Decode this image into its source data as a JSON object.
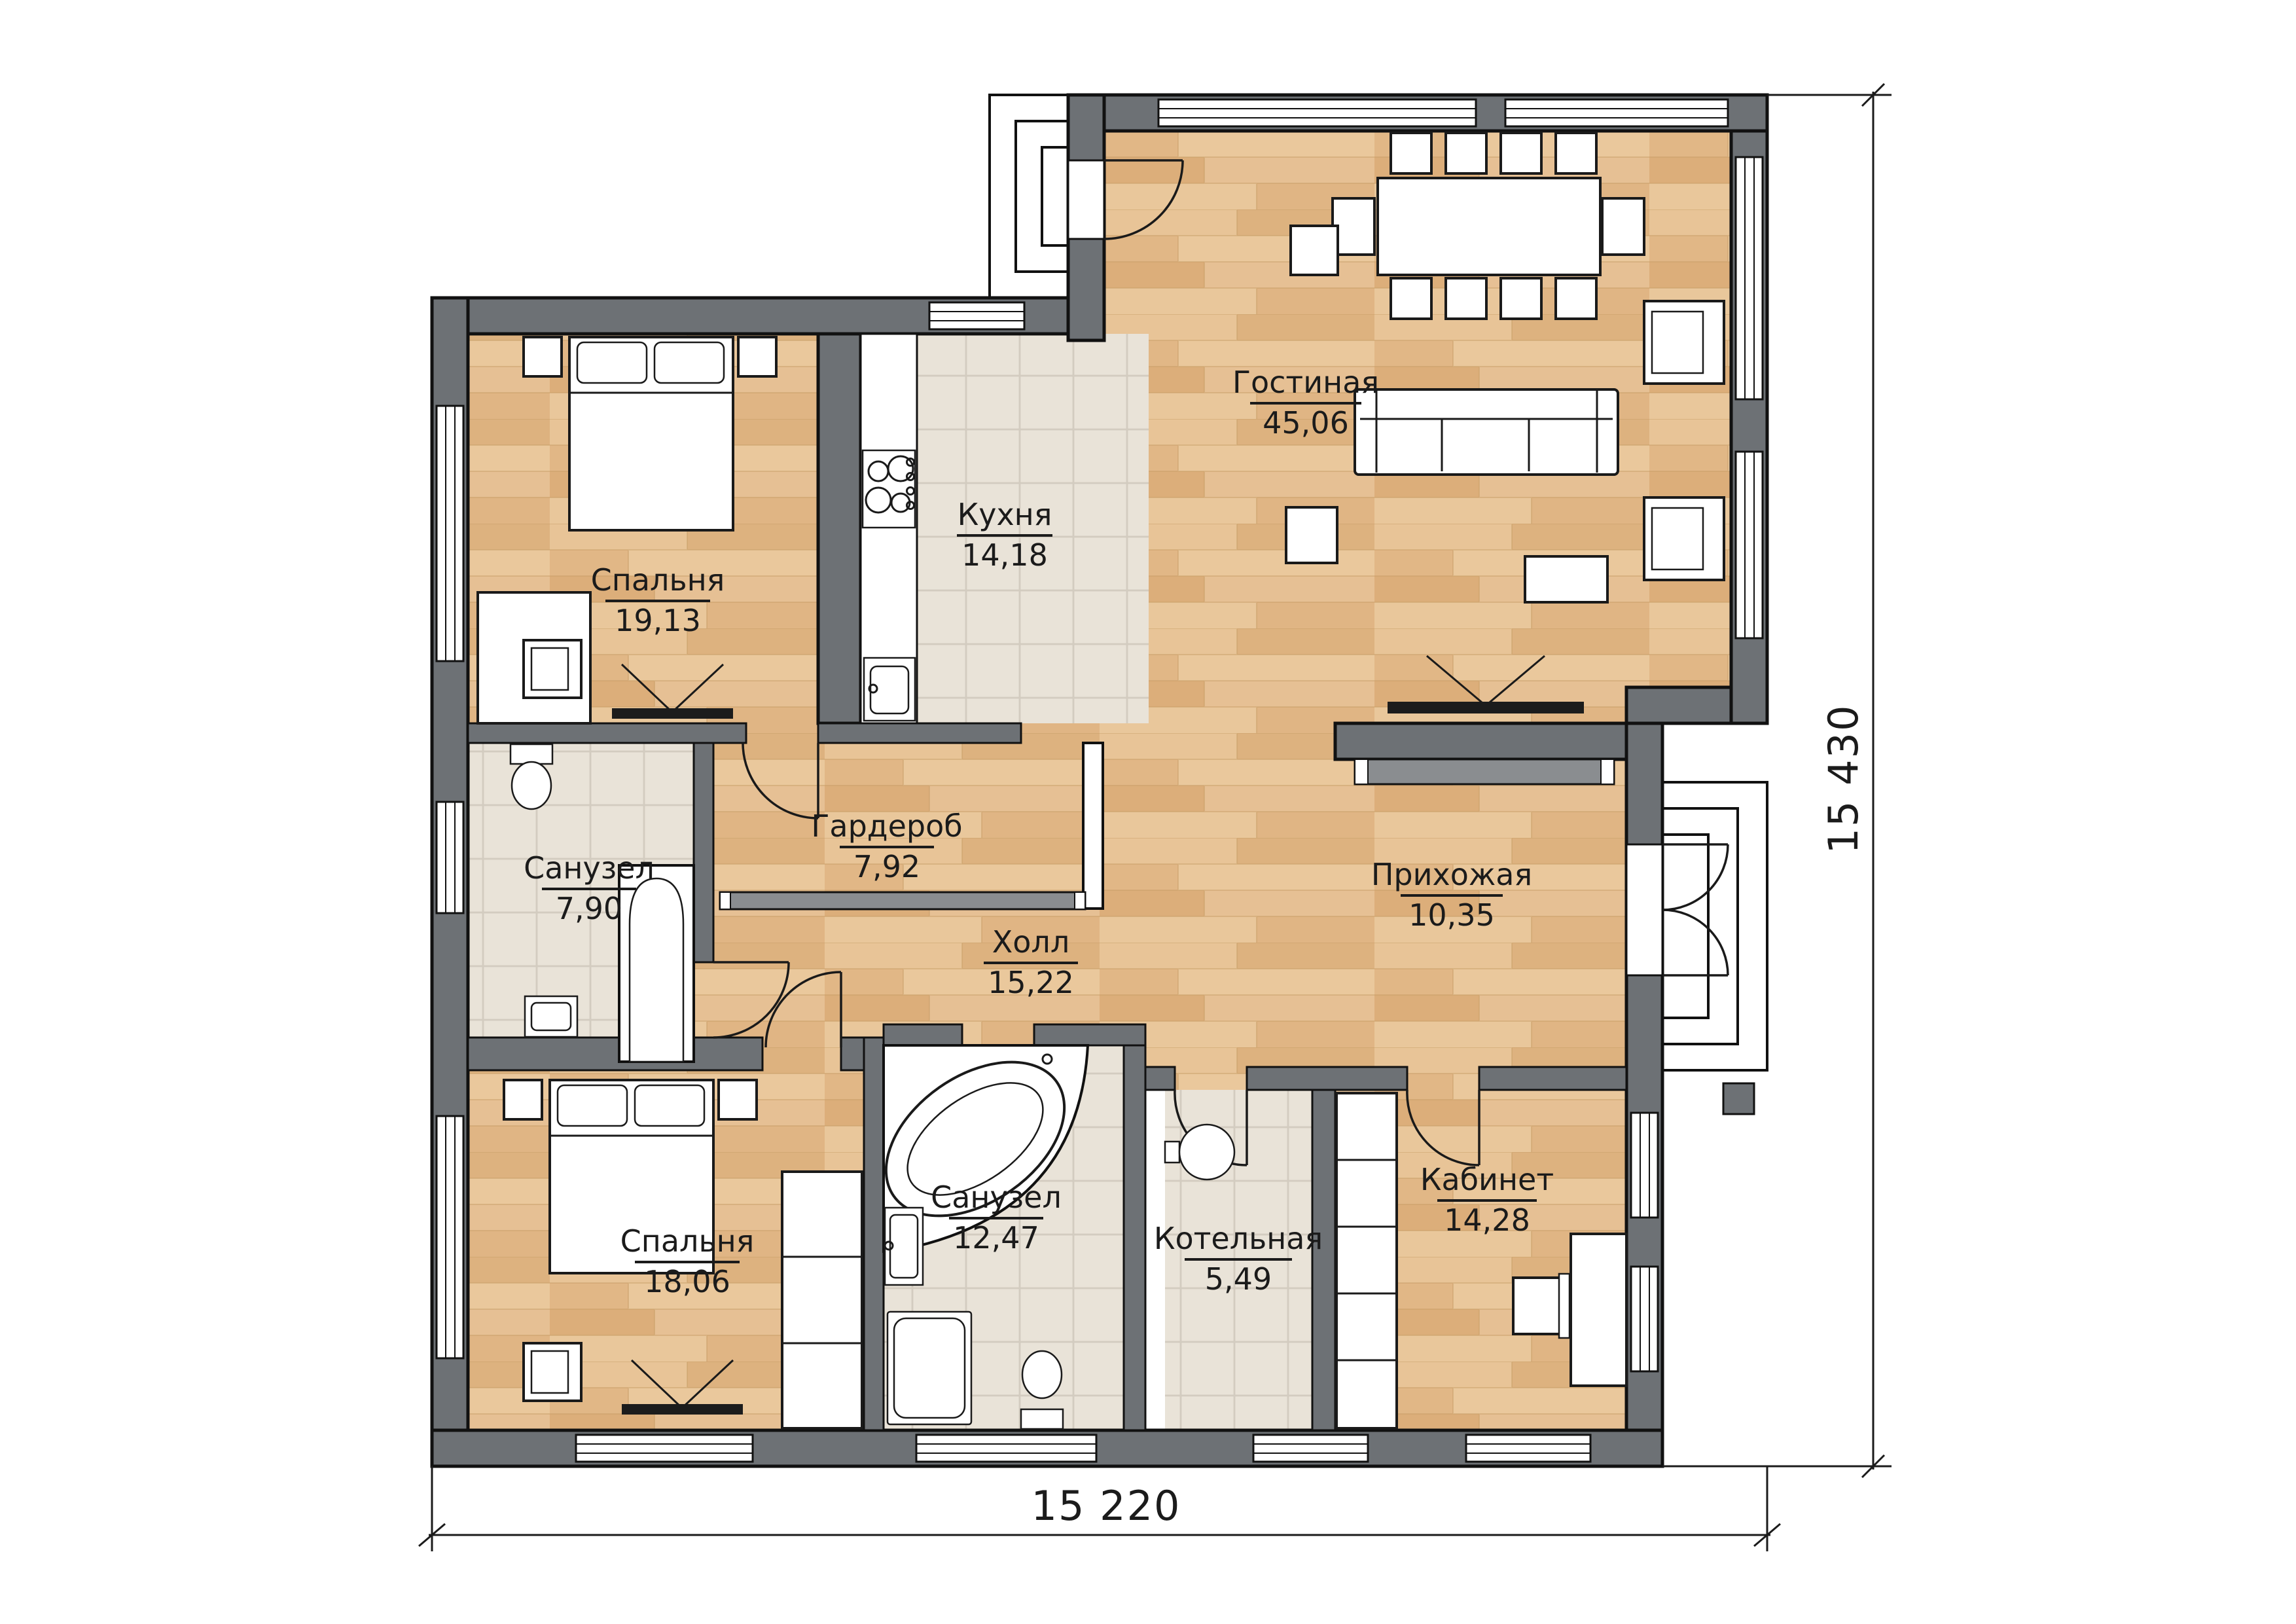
{
  "plan": {
    "type": "floor-plan",
    "language": "ru"
  },
  "rooms": [
    {
      "name": "Гостиная",
      "area": "45,06",
      "floor": "wood"
    },
    {
      "name": "Кухня",
      "area": "14,18",
      "floor": "tile"
    },
    {
      "name": "Спальня",
      "area": "19,13",
      "floor": "wood"
    },
    {
      "name": "Санузел",
      "area": "7,90",
      "floor": "tile"
    },
    {
      "name": "Гардероб",
      "area": "7,92",
      "floor": "wood"
    },
    {
      "name": "Холл",
      "area": "15,22",
      "floor": "wood"
    },
    {
      "name": "Прихожая",
      "area": "10,35",
      "floor": "wood"
    },
    {
      "name": "Спальня",
      "area": "18,06",
      "floor": "wood"
    },
    {
      "name": "Санузел",
      "area": "12,47",
      "floor": "tile"
    },
    {
      "name": "Котельная",
      "area": "5,49",
      "floor": "tile"
    },
    {
      "name": "Кабинет",
      "area": "14,28",
      "floor": "wood"
    }
  ],
  "dimensions": {
    "bottom": "15 220",
    "right": "15 430"
  },
  "colors": {
    "wall": "#6d7175",
    "wood_floor": "#e4bd8e",
    "tile_floor": "#ece6dc",
    "line": "#1a1a1a",
    "background": "#ffffff"
  }
}
